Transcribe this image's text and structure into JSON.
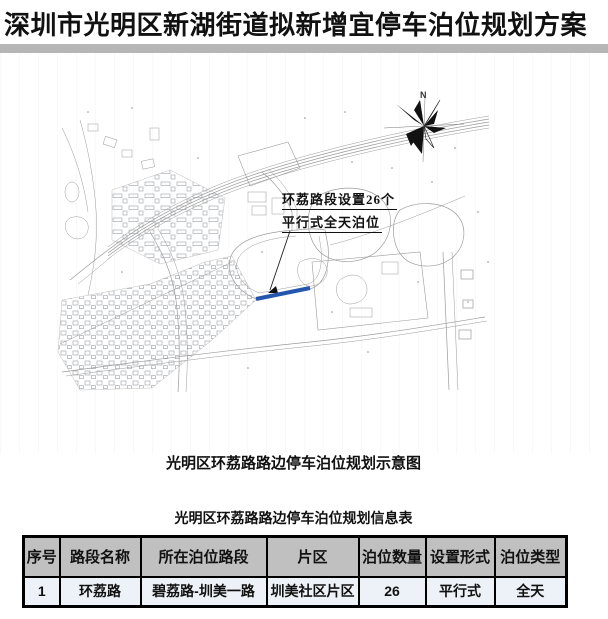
{
  "document": {
    "title": "深圳市光明区新湖街道拟新增宜停车泊位规划方案"
  },
  "map": {
    "compass_label": "N",
    "annotation": {
      "line1": "环荔路段设置26个",
      "line2": "平行式全天泊位"
    },
    "caption": "光明区环荔路路边停车泊位规划示意图"
  },
  "table": {
    "title": "光明区环荔路路边停车泊位规划信息表",
    "headers": [
      "序号",
      "路段名称",
      "所在泊位路段",
      "片区",
      "泊位数量",
      "设置形式",
      "泊位类型"
    ],
    "rows": [
      {
        "no": "1",
        "road_name": "环荔路",
        "section": "碧荔路-圳美一路",
        "district": "圳美社区片区",
        "count": "26",
        "form": "平行式",
        "type": "全天"
      }
    ]
  },
  "colors": {
    "accent_blue": "#2456ae",
    "header_bg": "#c0c0c0",
    "row_bg": "#edf2f8",
    "divider_gray": "#b6b6b6",
    "map_line_gray": "#9b9b9b"
  }
}
